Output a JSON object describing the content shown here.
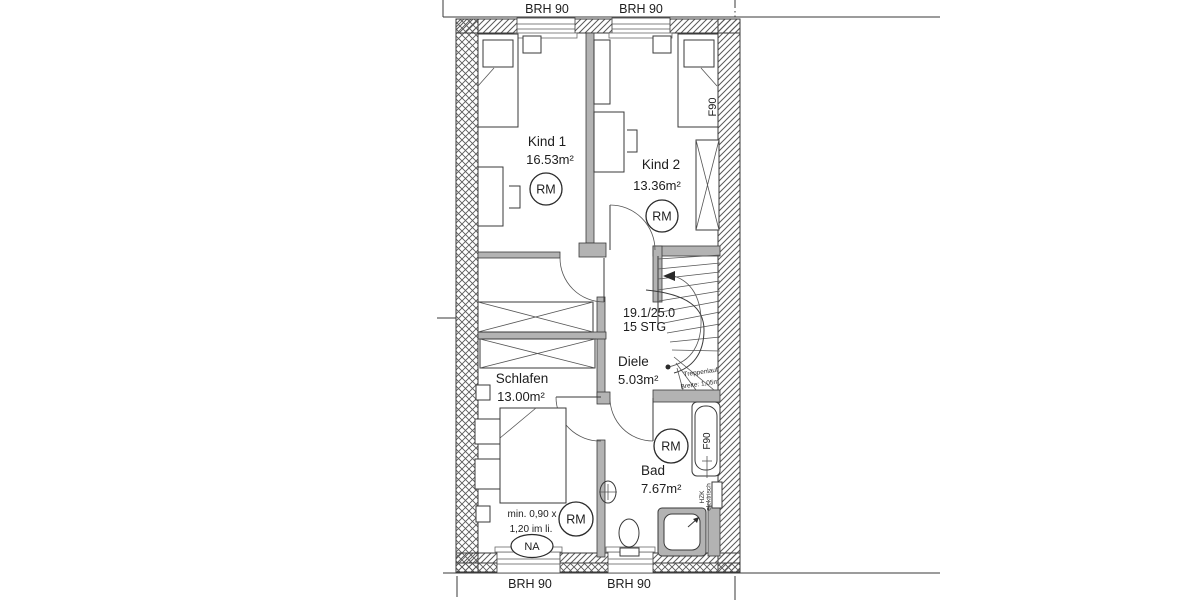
{
  "plan": {
    "title_hint": "Obergeschoss Grundriss",
    "labels": {
      "brh_top_left": "BRH 90",
      "brh_top_right": "BRH 90",
      "brh_bottom_left": "BRH 90",
      "brh_bottom_right": "BRH 90",
      "rm": "RM",
      "na": "NA",
      "f90_kind2": "F90",
      "f90_bath": "F90",
      "hzk": "HZK",
      "elektrisch": "elektrisch",
      "stair_ratio": "19.1/25.0",
      "stair_steps": "15 STG",
      "stair_note_line1": "Treppenlauf",
      "stair_note_line2": "Breite: 1,05m",
      "window_note_line1": "min. 0,90 x",
      "window_note_line2": "1,20 im li."
    },
    "rooms": [
      {
        "name": "Kind 1",
        "area": "16.53m²"
      },
      {
        "name": "Kind 2",
        "area": "13.36m²"
      },
      {
        "name": "Diele",
        "area": "5.03m²"
      },
      {
        "name": "Schlafen",
        "area": "13.00m²"
      },
      {
        "name": "Bad",
        "area": "7.67m²"
      }
    ]
  }
}
